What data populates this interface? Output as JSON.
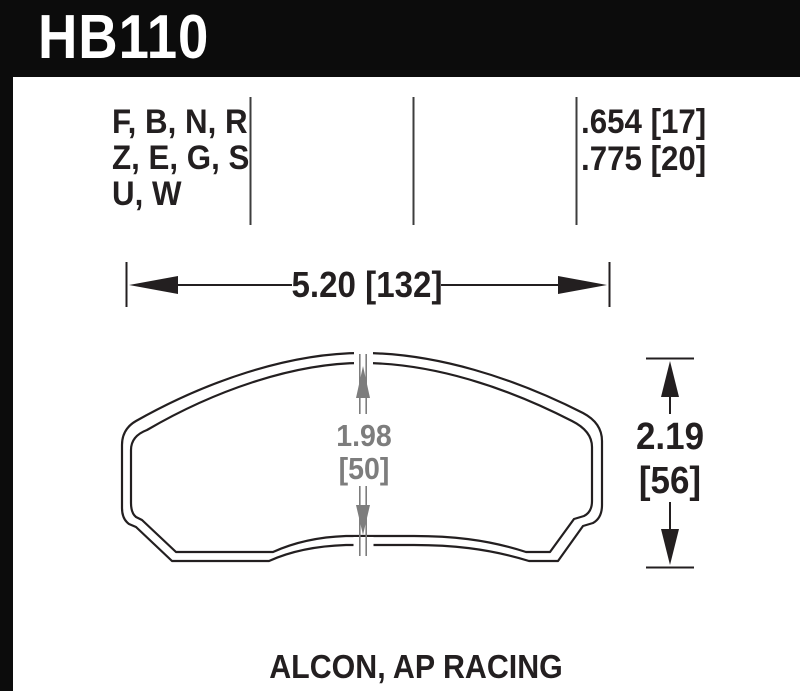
{
  "header": {
    "part_number": "HB110"
  },
  "spec_table": {
    "compound_lines": [
      "F, B, N, R",
      "Z, E, G, S",
      "U, W"
    ],
    "thickness_lines": [
      ".654 [17]",
      ".775 [20]"
    ]
  },
  "dimensions": {
    "width_label": "5.20 [132]",
    "height_label_in": "2.19",
    "height_label_mm": "[56]",
    "center_label_in": "1.98",
    "center_label_mm": "[50]"
  },
  "footer": {
    "applications_label": "ALCON, AP RACING"
  },
  "colors": {
    "ink": "#231f20",
    "dim_gray": "#7d7d7d",
    "header_bg": "#0c0c0c",
    "background": "#ffffff"
  }
}
